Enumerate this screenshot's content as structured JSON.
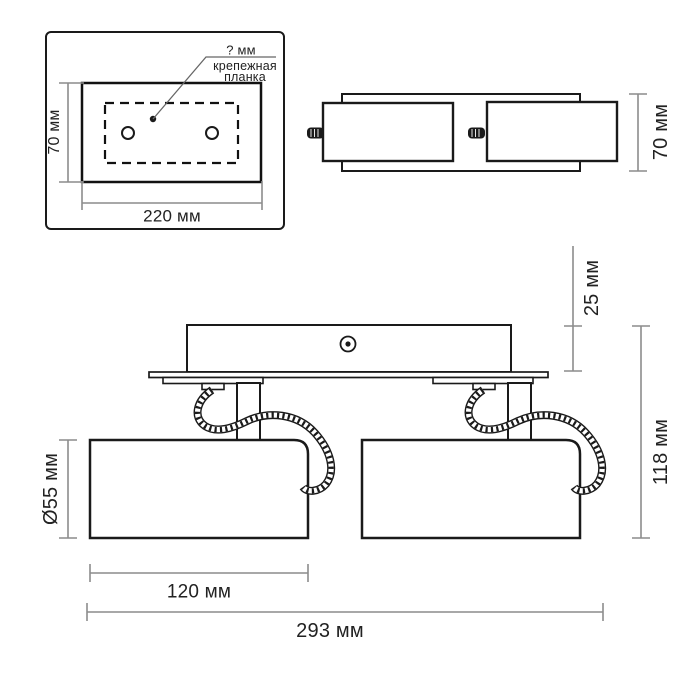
{
  "labels": {
    "hole_diameter": "? мм",
    "mounting_bar_line1": "крепежная",
    "mounting_bar_line2": "планка",
    "inset_plate_height": "70 мм",
    "inset_plate_width": "220 мм",
    "top_view_depth": "70 мм",
    "base_offset": "25 мм",
    "total_height": "118 мм",
    "shade_diameter": "Ø55 мм",
    "shade_length": "120 мм",
    "total_width": "293 мм"
  },
  "colors": {
    "outline": "#1a1a1a",
    "dimension_line": "#8c8c8c",
    "text": "#222222",
    "background": "#ffffff"
  }
}
